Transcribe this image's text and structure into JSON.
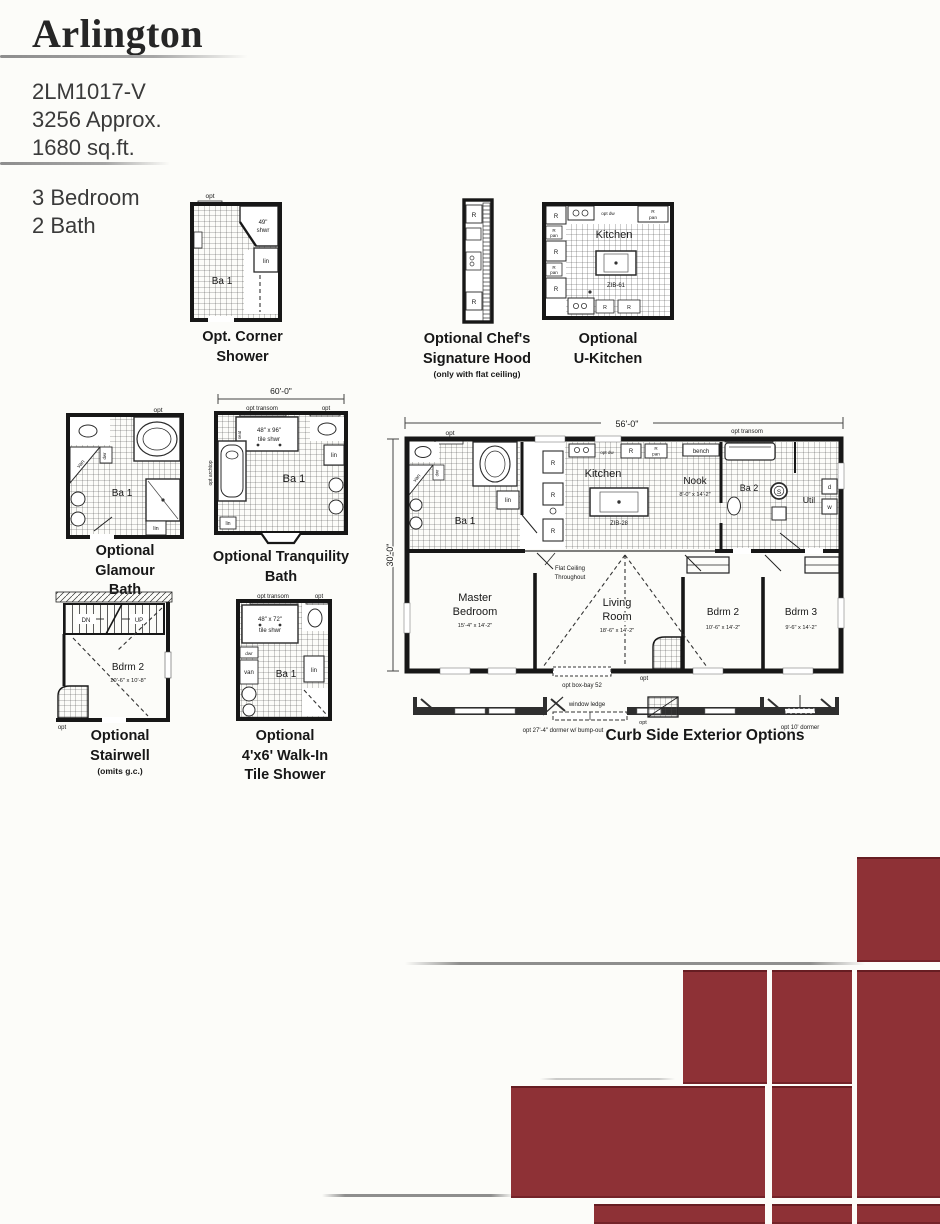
{
  "header": {
    "title": "Arlington",
    "model": "2LM1017-V",
    "approx": "3256 Approx.",
    "sqft": "1680 sq.ft.",
    "bedrooms": "3 Bedroom",
    "baths": "2 Bath"
  },
  "shared": {
    "opt": "opt",
    "r": "R",
    "pan": "pan",
    "lin": "lin",
    "van": "van",
    "dwr": "dwr",
    "seat": "seat",
    "ba1": "Ba 1",
    "ba2": "Ba 2",
    "kitchen": "Kitchen",
    "opt_dw": "opt dw",
    "opt_transom": "opt transom",
    "bench": "bench"
  },
  "corner_shower": {
    "shwr_size": "49\"",
    "shwr": "shwr",
    "caption1": "Opt. Corner",
    "caption2": "Shower"
  },
  "chefs_hood": {
    "caption1": "Optional Chef's",
    "caption2": "Signature Hood",
    "note": "(only with flat ceiling)"
  },
  "u_kitchen": {
    "island": "ZIB-61",
    "caption1": "Optional",
    "caption2": "U-Kitchen"
  },
  "glamour": {
    "caption1": "Optional",
    "caption2": "Glamour",
    "caption3": "Bath"
  },
  "tranquility": {
    "dim": "60'-0\"",
    "shwr_size": "48\" x 96\"",
    "shwr": "tile shwr",
    "archtop": "opt archtop",
    "caption1": "Optional Tranquility",
    "caption2": "Bath"
  },
  "stairwell": {
    "dn": "DN",
    "up": "UP",
    "room": "Bdrm 2",
    "size": "10'-6\" x 10'-8\"",
    "caption1": "Optional",
    "caption2": "Stairwell",
    "note": "(omits g.c.)"
  },
  "walkin": {
    "shwr_size": "48\" x 72\"",
    "shwr": "tile shwr",
    "caption1": "Optional",
    "caption2": "4'x6' Walk-In",
    "caption3": "Tile Shower"
  },
  "main_plan": {
    "width_dim": "56'-0\"",
    "height_dim": "30'-0\"",
    "island": "ZIB-28",
    "nook": "Nook",
    "nook_size": "8'-0\" x 14'-2\"",
    "flat1": "Flat Ceiling",
    "flat2": "Throughout",
    "master1": "Master",
    "master2": "Bedroom",
    "master_size": "15'-4\" x 14'-2\"",
    "living1": "Living",
    "living2": "Room",
    "living_size": "18'-6\" x 14'-2\"",
    "bdrm2": "Bdrm 2",
    "bdrm2_size": "10'-6\" x 14'-2\"",
    "bdrm3": "Bdrm 3",
    "bdrm3_size": "9'-6\" x 14'-2\"",
    "boxbay": "opt box-bay 52",
    "util": "Util",
    "s": "S",
    "d": "d",
    "w": "w"
  },
  "curb": {
    "window_ledge": "window ledge",
    "dormer27": "opt 27'-4\" dormer w/ bump-out",
    "dormer10": "opt 10' dormer",
    "caption": "Curb Side Exterior Options"
  },
  "colors": {
    "tile_red": "#8e3136"
  }
}
